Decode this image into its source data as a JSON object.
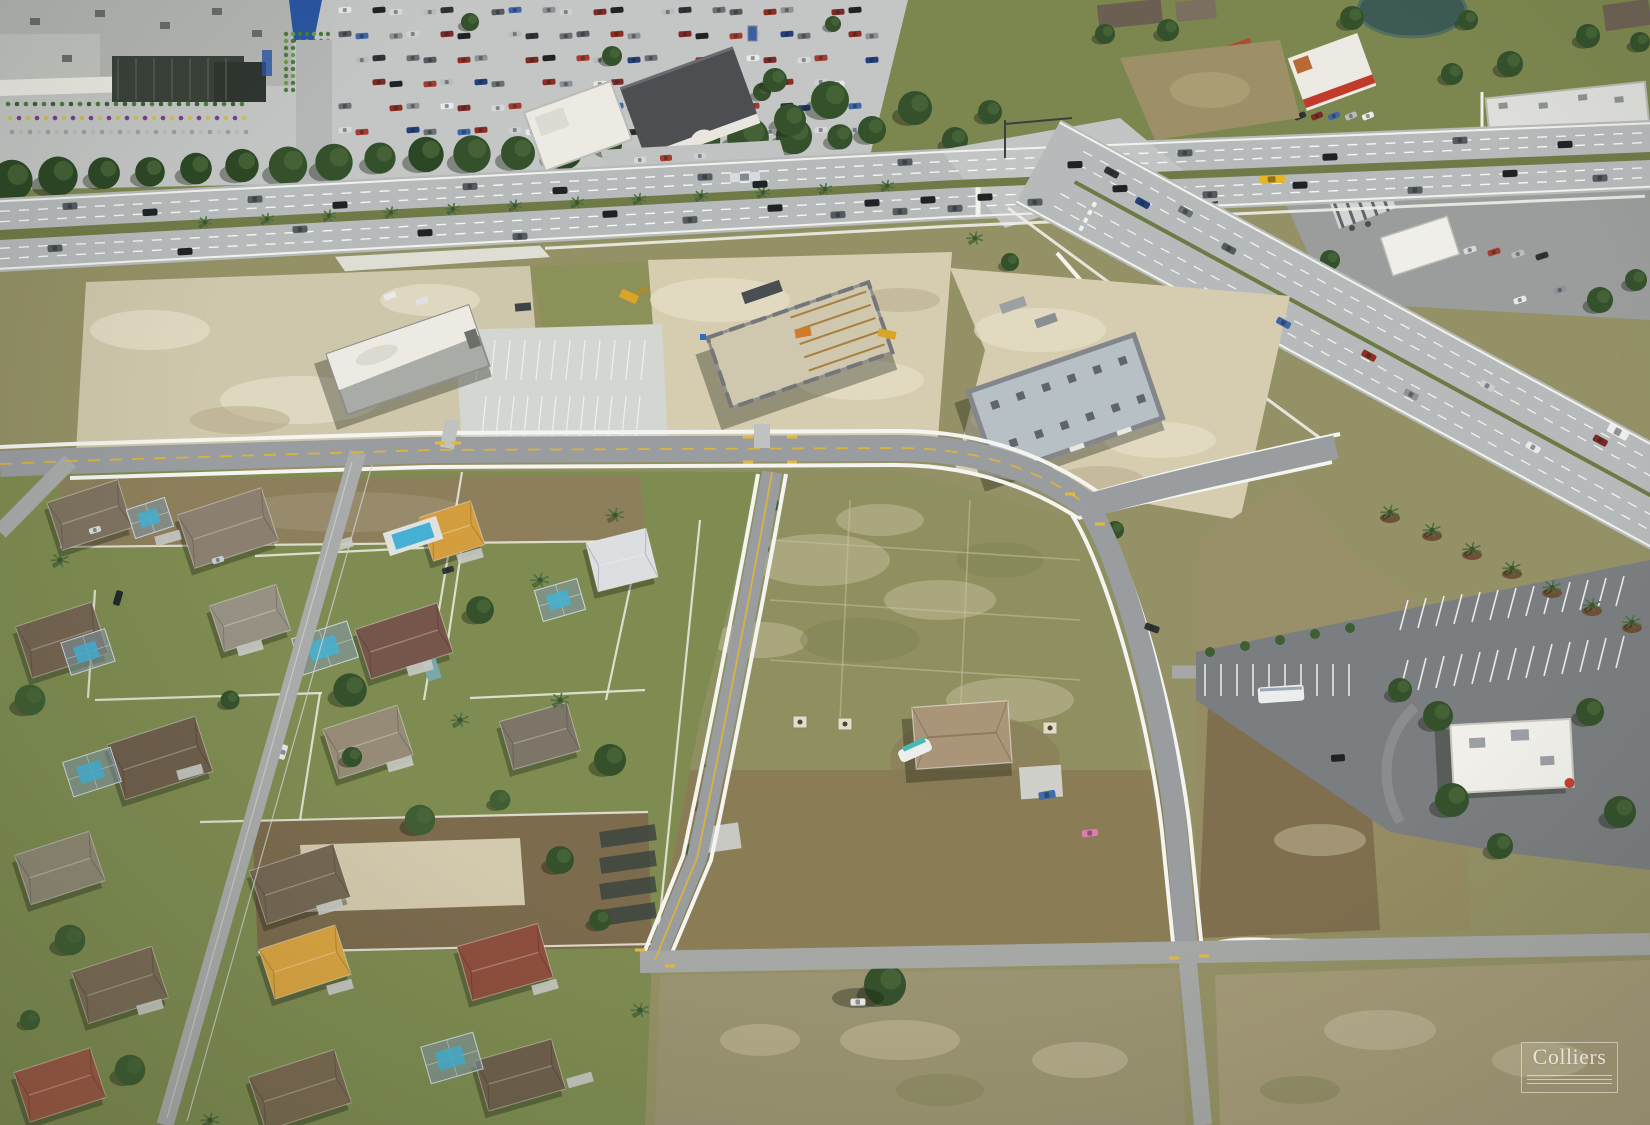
{
  "document": {
    "type": "aerial-photograph",
    "width_px": 1650,
    "height_px": 1125
  },
  "photo": {
    "description": "Oblique aerial photograph of a suburban commercial corner: a big-box shopping center with a full parking lot and outparcel buildings along a six-lane divided arterial, a signalized intersection where a second divided highway diverges to the southeast, three retail buildings under construction on cleared sand pads served by new white-curbed access roads, large vacant grass-and-dirt parcels, a fast-food outparcel with striped parking, and a single-family residential neighborhood with swimming pools and white fences in the lower left."
  },
  "watermark": {
    "text": "Colliers",
    "color": "#ffffff",
    "opacity": 0.78,
    "frame": "thin white rectangle with three rule lines below the serif wordmark"
  },
  "scene": {
    "regions": [
      {
        "name": "retail-center",
        "label": "Big-box retail store with garden center"
      },
      {
        "name": "retail-parking",
        "label": "Shopping center parking lot full of cars"
      },
      {
        "name": "main-highway",
        "label": "Six-lane divided arterial road with landscaped median"
      },
      {
        "name": "cross-highway",
        "label": "Divided highway diverging southeast"
      },
      {
        "name": "intersection",
        "label": "Signalized highway intersection with queued traffic"
      },
      {
        "name": "outparcel-buildings",
        "label": "Outparcel retail buildings along the arterial"
      },
      {
        "name": "pond",
        "label": "Retention pond"
      },
      {
        "name": "gas-station",
        "label": "Gas station canopy and convenience store"
      },
      {
        "name": "construction-site",
        "label": "Retail buildings under construction on sand pads"
      },
      {
        "name": "new-access-roads",
        "label": "New curbed access roads with white sidewalks"
      },
      {
        "name": "vacant-parcels",
        "label": "Vacant commercial land parcels"
      },
      {
        "name": "residential-neighborhood",
        "label": "Single-family homes, pools and white fences"
      },
      {
        "name": "fast-food-outparcel",
        "label": "Fast-food restaurant with striped parking lot"
      },
      {
        "name": "lone-house",
        "label": "Single house on vacant block with boat and pink car"
      },
      {
        "name": "school-bus",
        "label": "Yellow school bus on the arterial"
      }
    ]
  },
  "palette": {
    "base": "#8e9061",
    "grass": "#7c874f",
    "lawn": "#7e8c52",
    "dryField": "#9b9168",
    "deadGrass": "#a9a07e",
    "dirtStrip": "#8d7f5c",
    "tilled": "#7c6b4d",
    "sand": "#d6cdb0",
    "sandLight": "#e6dfc9",
    "blotchDark": "#b4a886",
    "asphalt": "#b7babb",
    "asphaltOld": "#a6a8a6",
    "asphaltNew": "#9a9da0",
    "asphaltDark": "#7b7e80",
    "concrete": "#c6c9c7",
    "lineWhite": "#f2f2ec",
    "curbYellow": "#d9b33e",
    "treeDark": "#34512c",
    "treeMid": "#4a673a",
    "palmGreen": "#4f7040",
    "mulch": "#6e4f37",
    "roofGrey": "#b4b6b3",
    "roofWhite": "#eceae2",
    "roofDark": "#4b4c50",
    "roofRed": "#a5512e",
    "roofBrown": "#6e5a48",
    "gardenDark": "#39413a",
    "water": "#3d5a55",
    "poolBlue": "#45b0d4",
    "screen": "#8fa0ad",
    "fence": "#efece2",
    "shadow": "rgba(25,32,18,0.35)",
    "vehicles": [
      "#e8e9ea",
      "#d7d8da",
      "#2f3338",
      "#565b60",
      "#8e9296",
      "#7d2a26",
      "#a43c2e",
      "#24407c",
      "#3f66a8",
      "#cdd0d3",
      "#1f2326",
      "#b8bcbf",
      "#6b7074",
      "#902c22"
    ]
  }
}
